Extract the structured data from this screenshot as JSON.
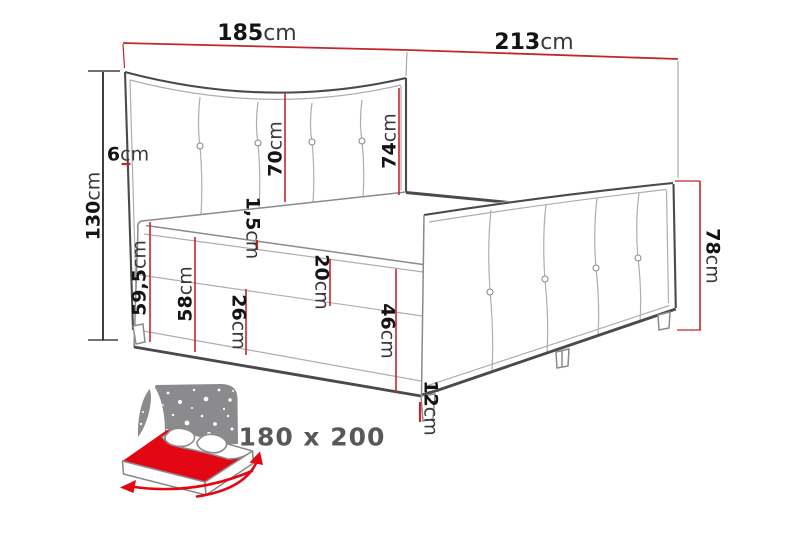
{
  "figure": {
    "size_label": "180 x 200",
    "dims": {
      "d185": {
        "num": "185",
        "unit": "cm"
      },
      "d213": {
        "num": "213",
        "unit": "cm"
      },
      "d130": {
        "num": "130",
        "unit": "cm"
      },
      "d6": {
        "num": "6",
        "unit": "cm"
      },
      "d70": {
        "num": "70",
        "unit": "cm"
      },
      "d74": {
        "num": "74",
        "unit": "cm"
      },
      "d78": {
        "num": "78",
        "unit": "cm"
      },
      "d59_5": {
        "num": "59,5",
        "unit": "cm"
      },
      "d1_5": {
        "num": "1,5",
        "unit": "cm"
      },
      "d58": {
        "num": "58",
        "unit": "cm"
      },
      "d26": {
        "num": "26",
        "unit": "cm"
      },
      "d20": {
        "num": "20",
        "unit": "cm"
      },
      "d46": {
        "num": "46",
        "unit": "cm"
      },
      "d12": {
        "num": "12",
        "unit": "cm"
      }
    },
    "colors": {
      "dimension_red": "#c1272d",
      "black_line": "#1d1d1b",
      "number_text": "#141414",
      "unit_text": "#3a3a3c",
      "size_text": "#58585a",
      "outline_dark": "#4a4a4e",
      "outline_mid": "#8a8a8e",
      "outline_light": "#aeaeb2",
      "extension_gray": "#9b9b9f",
      "icon_red": "#e30613",
      "icon_gray": "#8b8b8d"
    }
  }
}
